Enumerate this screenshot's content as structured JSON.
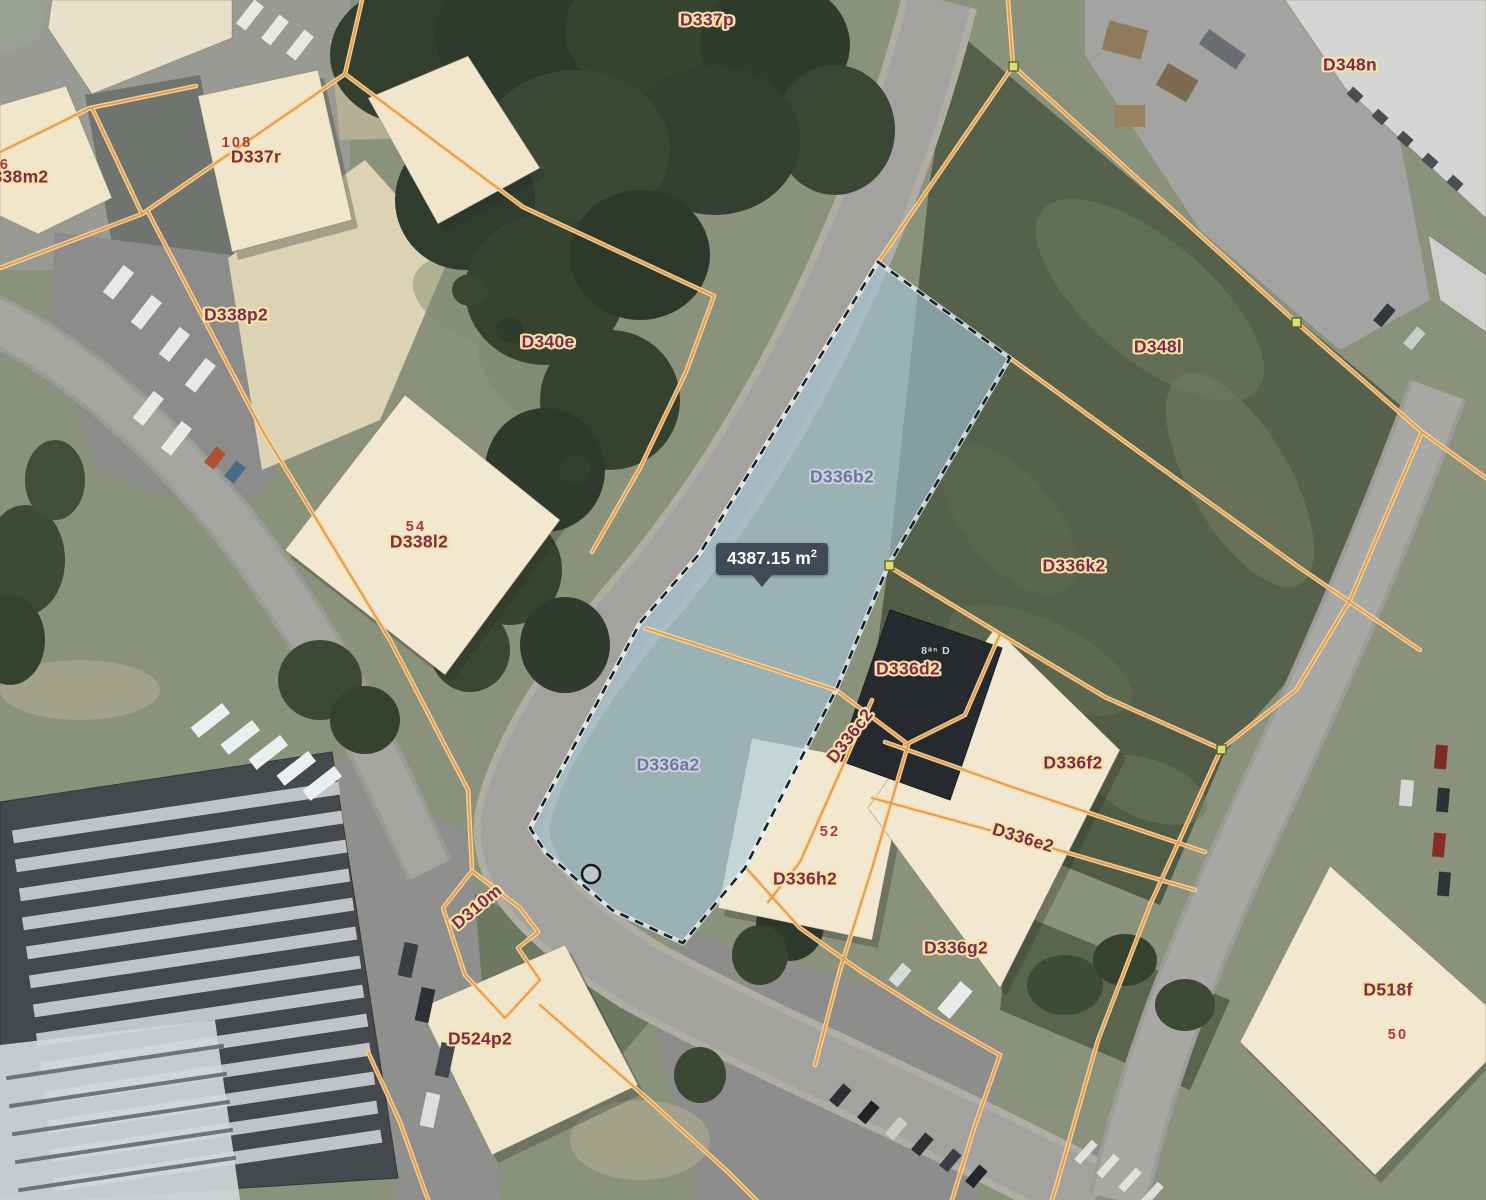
{
  "map": {
    "measurement_tooltip": {
      "value": "4387.15",
      "unit": "m",
      "unit_exponent": "2"
    },
    "parcel_labels": [
      {
        "id": "D337p",
        "x": 707,
        "y": 20
      },
      {
        "id": "D337r",
        "x": 256,
        "y": 157
      },
      {
        "id": "D338m2",
        "x": 14,
        "y": 177
      },
      {
        "id": "D338p2",
        "x": 236,
        "y": 315
      },
      {
        "id": "D340e",
        "x": 548,
        "y": 342
      },
      {
        "id": "D348n",
        "x": 1350,
        "y": 65
      },
      {
        "id": "D348l",
        "x": 1158,
        "y": 347
      },
      {
        "id": "D338l2",
        "x": 419,
        "y": 542
      },
      {
        "id": "D336b2",
        "x": 842,
        "y": 477,
        "variant": "muted"
      },
      {
        "id": "D336k2",
        "x": 1074,
        "y": 566
      },
      {
        "id": "D336d2",
        "x": 908,
        "y": 669
      },
      {
        "id": "D336c2",
        "x": 850,
        "y": 736,
        "rot": -52
      },
      {
        "id": "D336a2",
        "x": 668,
        "y": 765,
        "variant": "muted"
      },
      {
        "id": "D336f2",
        "x": 1073,
        "y": 763
      },
      {
        "id": "D336e2",
        "x": 1023,
        "y": 838,
        "rot": 17
      },
      {
        "id": "D336h2",
        "x": 805,
        "y": 879
      },
      {
        "id": "D336g2",
        "x": 956,
        "y": 948
      },
      {
        "id": "D310m",
        "x": 477,
        "y": 907,
        "rot": -40
      },
      {
        "id": "D524p2",
        "x": 480,
        "y": 1039
      },
      {
        "id": "D518f",
        "x": 1388,
        "y": 990
      }
    ],
    "house_numbers": [
      {
        "text": "108",
        "x": 237,
        "y": 143
      },
      {
        "text": "6",
        "x": 5,
        "y": 165
      },
      {
        "text": "54",
        "x": 416,
        "y": 527
      },
      {
        "text": "52",
        "x": 830,
        "y": 832
      },
      {
        "text": "50",
        "x": 1398,
        "y": 1035
      }
    ],
    "roof_text": {
      "text": "8ᵃⁿ D",
      "x": 936,
      "y": 651
    },
    "colors": {
      "cad-line": "#e69a4a",
      "cad-halo": "#f8d79e",
      "selection-fill": "#a5c8da",
      "selection-stroke": "#14222a",
      "label-color": "#7c2b50",
      "label-halo": "#f8e2a4",
      "label-muted-color": "#6f74a0",
      "label-muted-halo": "#c9d4da",
      "number-color": "#b23830",
      "tooltip-bg": "#3e4a56",
      "tooltip-text": "#ffffff",
      "vertex-fill": "#d9e06b"
    }
  }
}
